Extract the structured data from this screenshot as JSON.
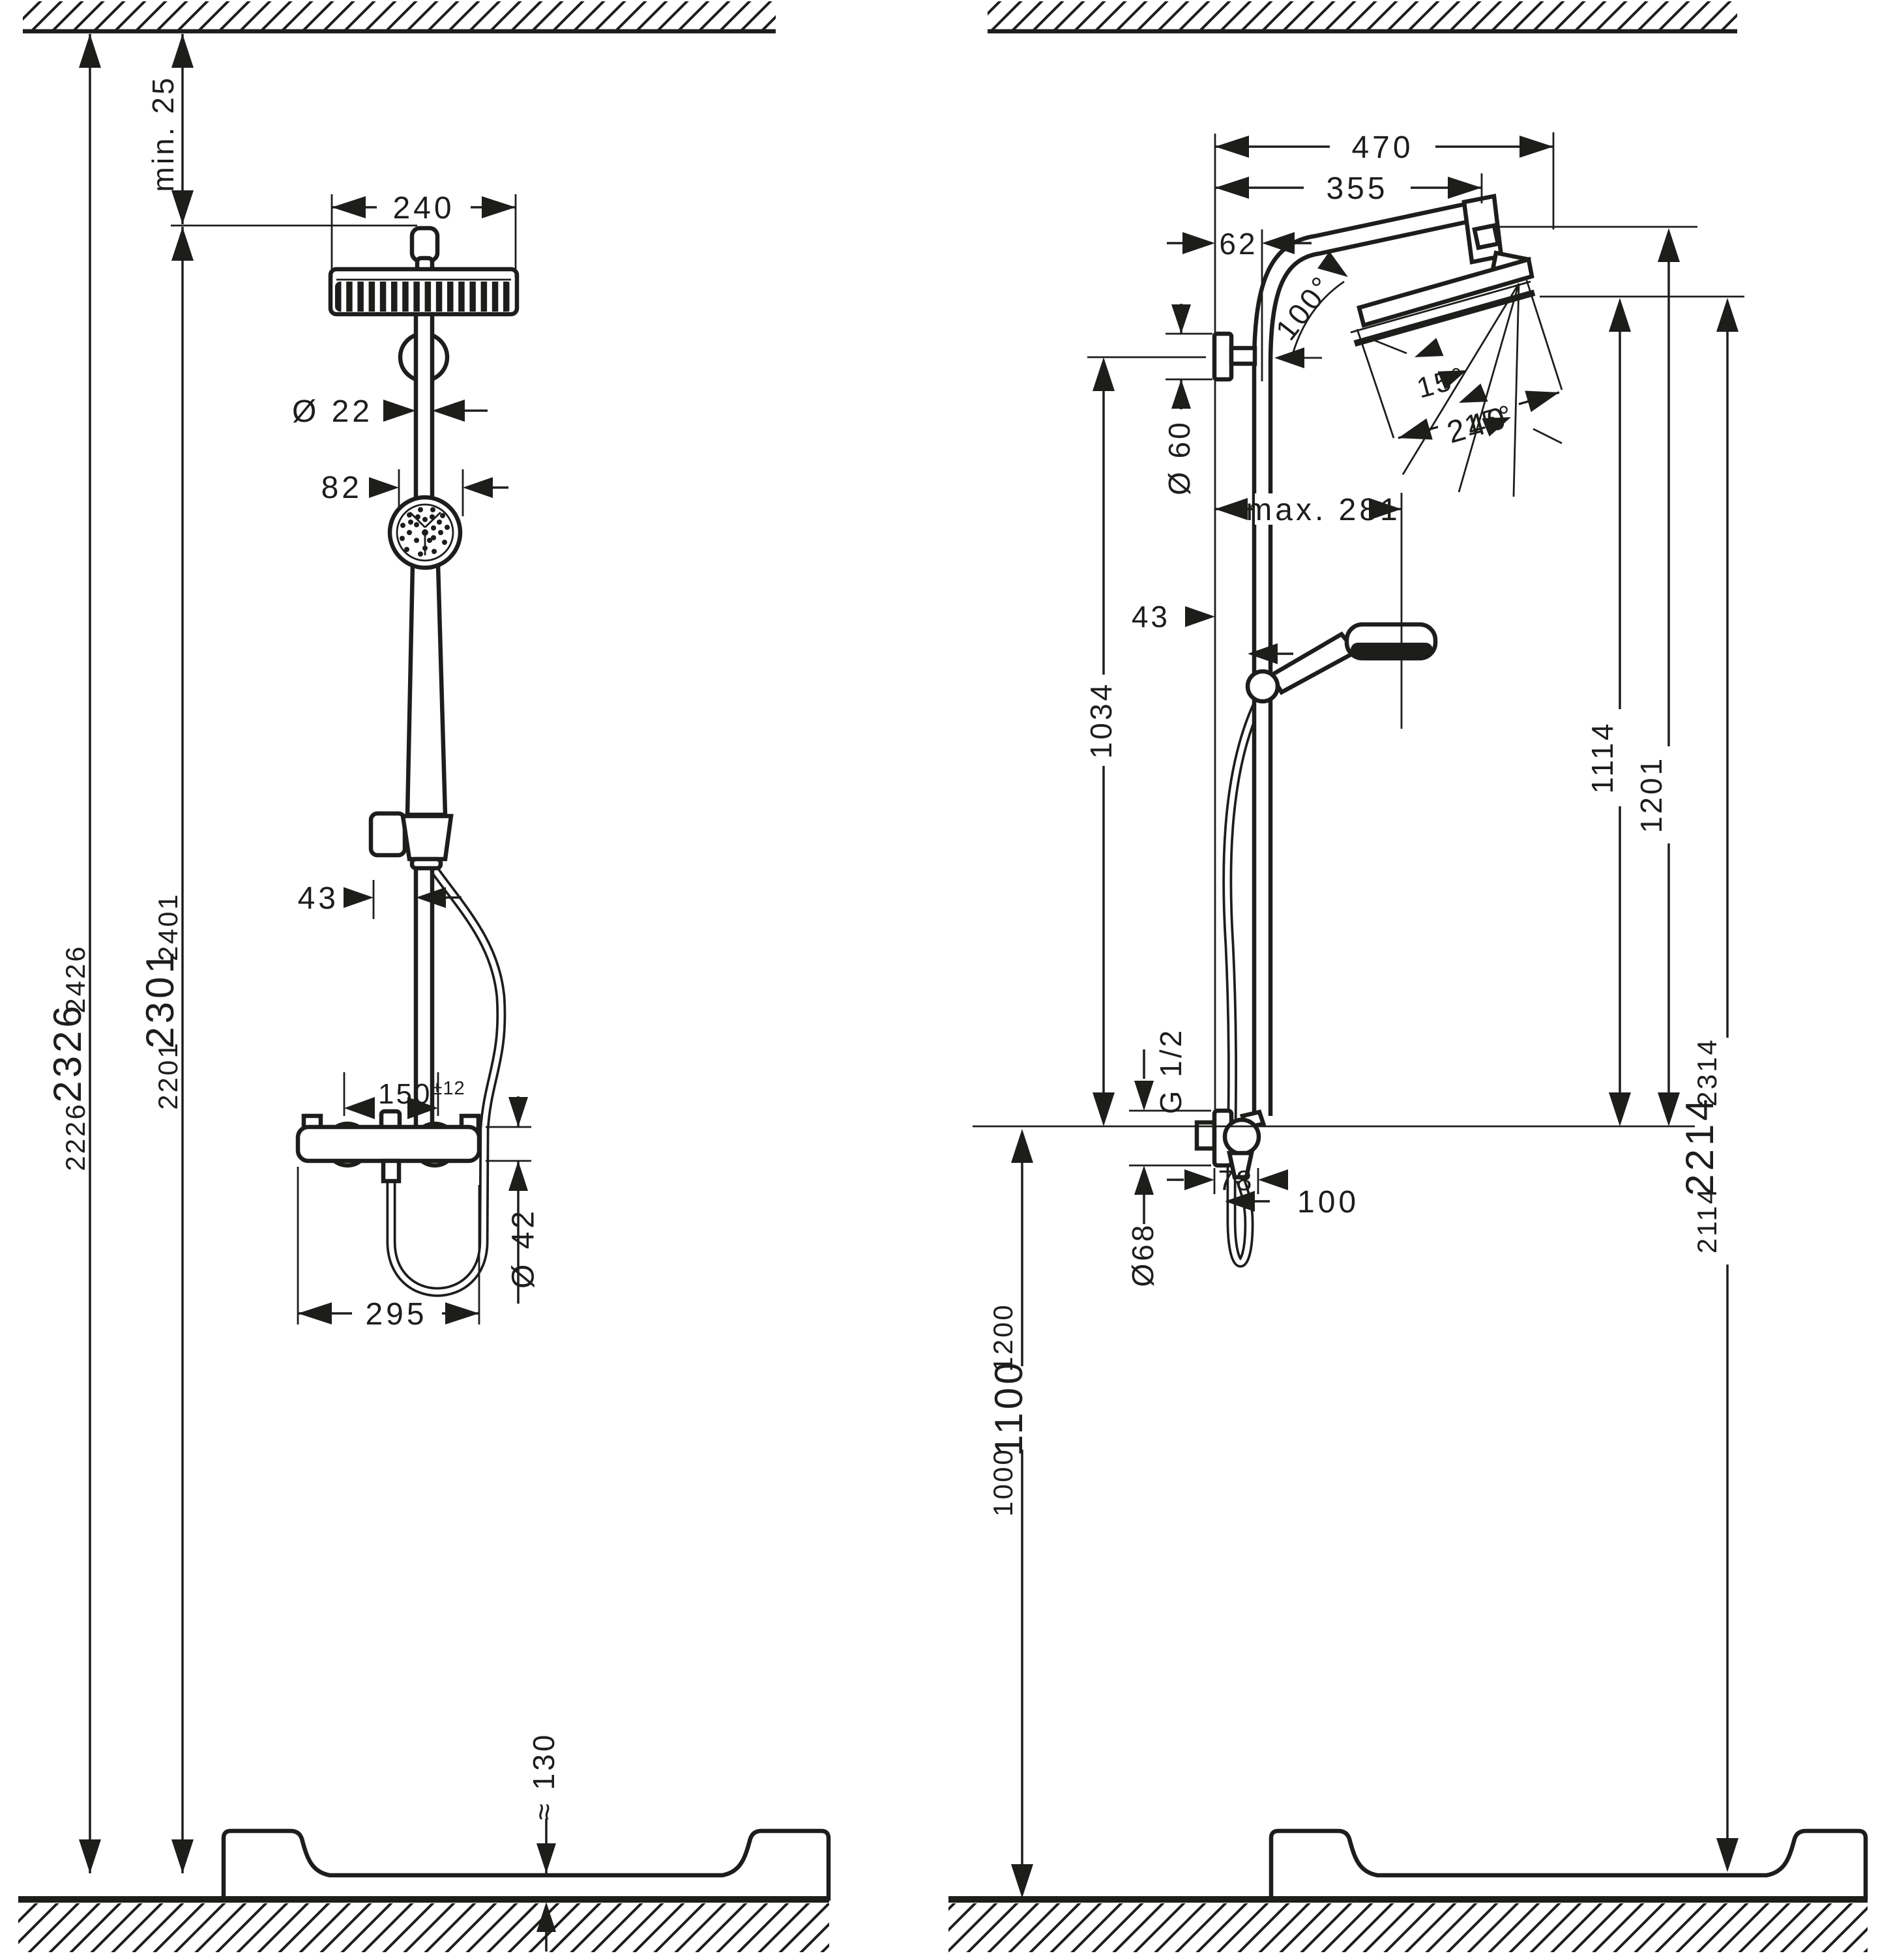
{
  "document": {
    "type": "technical installation dimension drawing",
    "subject": "shower pipe system with overhead shower, hand shower and exposed thermostat",
    "views": [
      "front elevation",
      "side elevation"
    ],
    "line_color": "#1d1d1b",
    "background": "#ffffff"
  },
  "front": {
    "min_clearance": "min. 25",
    "head_width": "240",
    "pipe_dia": "Ø 22",
    "hand_offset": "82",
    "holder_offset": "43",
    "conn_spacing": "150",
    "conn_tol": "±12",
    "union_dia": "Ø 42",
    "valve_width": "295",
    "tray_height": "≈ 130",
    "h_small_low": "2226",
    "h_big": "2326",
    "h_small_high": "2426",
    "p_small_low": "2201",
    "p_big": "2301",
    "p_small_high": "2401"
  },
  "side": {
    "reach_total": "470",
    "reach_arm": "355",
    "wall_offset": "62",
    "arm_angle": "100°",
    "tilt_a": "15°",
    "tilt_b": "15°",
    "head_len": "240",
    "flange_dia": "Ø 60",
    "max_reach": "max. 281",
    "holder_offset": "43",
    "bracket_h": "1034",
    "face_h": "1114",
    "top_h": "1201",
    "thread": "G 1/2",
    "valve_flange_dia": "Ø68",
    "valve_depth": "78",
    "valve_proj": "100",
    "i_small_low": "1000",
    "i_big": "1100",
    "i_small_high": "1200",
    "hd_small_low": "2114",
    "hd_big": "2214",
    "hd_small_high": "2314"
  }
}
